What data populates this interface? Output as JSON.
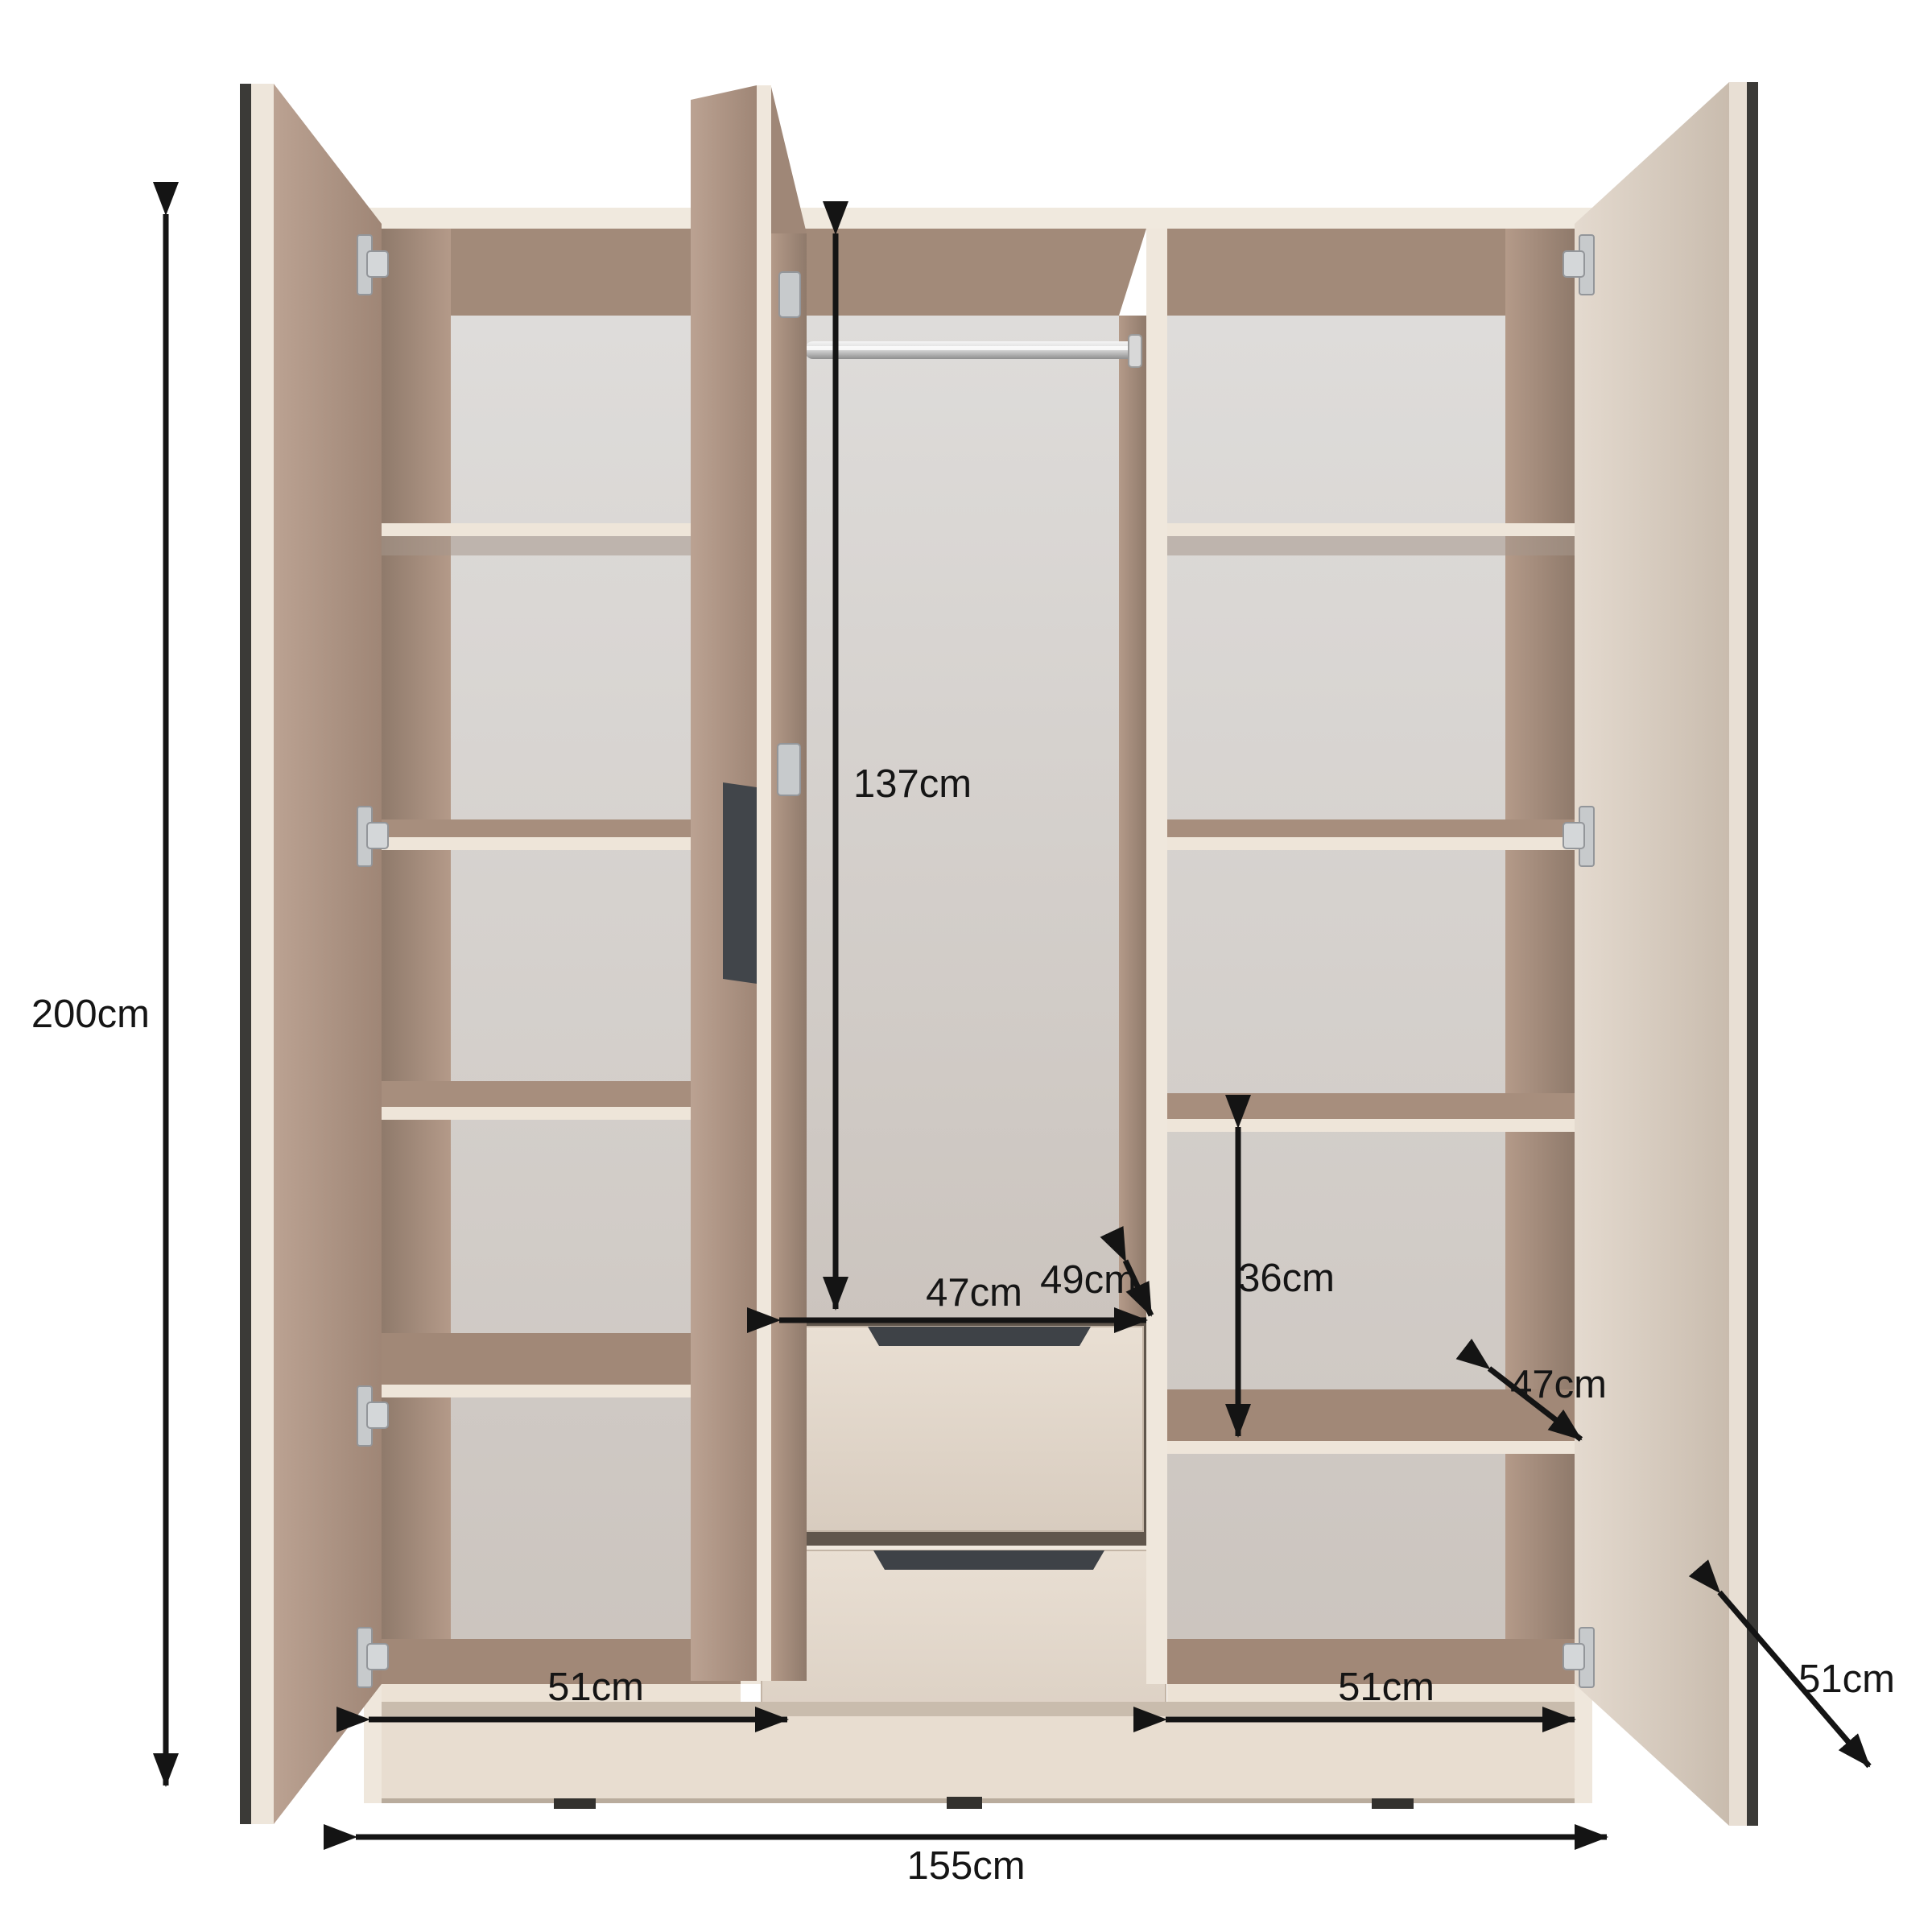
{
  "diagram": {
    "title": "wardrobe-dimensions-diagram",
    "labels": {
      "total_height": "200cm",
      "hanging_height": "137cm",
      "hanging_width": "47cm",
      "hanging_depth": "49cm",
      "right_shelf_gap": "36cm",
      "right_shelf_depth": "47cm",
      "left_compartment_width": "51cm",
      "right_compartment_width": "51cm",
      "side_depth": "51cm",
      "total_width": "155cm"
    },
    "colors": {
      "arrow": "#141414",
      "carcass_edge": "#efe7dc",
      "interior_wall": "#a98f7e",
      "back_panel": "#d8d5d3",
      "door_inner": "#b39a8a",
      "door_edge_dark": "#3b3a37",
      "drawer_front": "#e2d7cb",
      "handle": "#3e4247",
      "hinge": "#c7cacc",
      "rail": "#cfcfcf"
    }
  }
}
